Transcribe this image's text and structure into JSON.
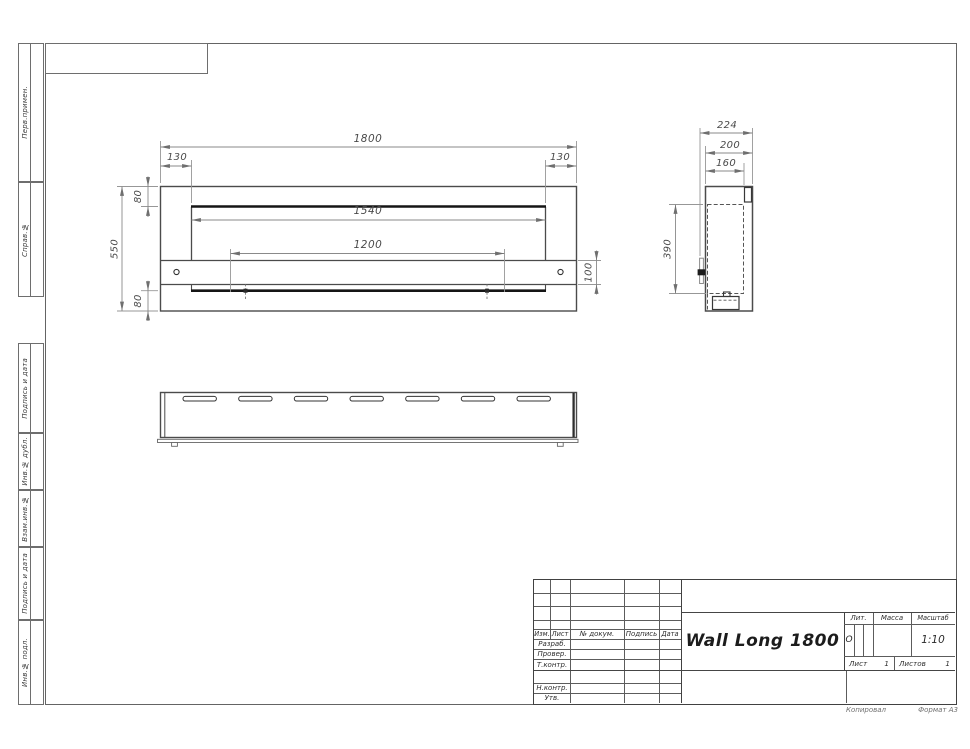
{
  "drawing_frame": {
    "margin_labels": {
      "perv_primen": "Перв.примен.",
      "sprav_no": "Справ.№",
      "podpis_data_1": "Подпись и дата",
      "inv_dubl": "Инв.№ дубл.",
      "vzam_inv": "Взам.инв.№",
      "podpis_data_2": "Подпись и дата",
      "inv_podl": "Инв.№ подл."
    },
    "footer": {
      "copied": "Копировал",
      "format": "Формат А3"
    }
  },
  "title_block": {
    "title": "Wall Long 1800",
    "columns": {
      "izm": "Изм.",
      "list": "Лист",
      "doc": "№ докум.",
      "sign": "Подпись",
      "date": "Дата"
    },
    "rows": {
      "developed": "Разраб.",
      "checked": "Провер.",
      "tcontrol": "Т.контр.",
      "ncontrol": "Н.контр.",
      "approved": "Утв."
    },
    "lit": {
      "label": "Лит.",
      "value": "О"
    },
    "mass": {
      "label": "Масса"
    },
    "scale": {
      "label": "Масштаб",
      "value": "1:10"
    },
    "sheet": {
      "label": "Лист",
      "value": "1"
    },
    "sheets": {
      "label": "Листов",
      "value": "1"
    }
  },
  "dimensions": {
    "front": {
      "width": "1800",
      "margin_left": "130",
      "margin_right": "130",
      "top_offset": "80",
      "opening_width": "1540",
      "burner_width": "1200",
      "height": "550",
      "strip_height": "100",
      "bottom_offset": "80"
    },
    "side": {
      "depth_total": "224",
      "depth_body": "200",
      "depth_inner": "160",
      "opening_height": "390"
    }
  }
}
